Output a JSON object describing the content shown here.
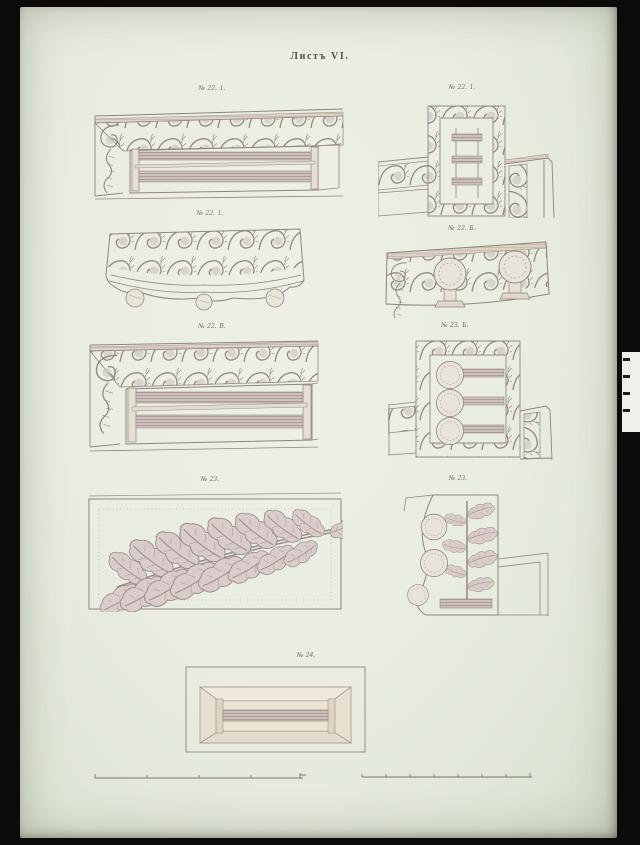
{
  "title": "Листъ VI.",
  "figures": [
    {
      "label": "№ 22. 1."
    },
    {
      "label": "№ 22. 1."
    },
    {
      "label": "№ 22. 1."
    },
    {
      "label": "№ 22. Б."
    },
    {
      "label": "№ 22. В."
    },
    {
      "label": "№ 23. Б."
    },
    {
      "label": "№ 23."
    },
    {
      "label": "№ 23."
    },
    {
      "label": "№ 24."
    }
  ],
  "colors": {
    "background": "#0c0b09",
    "paper": "#e9eee1",
    "ink": "#8f847e",
    "ornament_fill": "#cfc2c3",
    "shade_band": "#b9aba6"
  }
}
